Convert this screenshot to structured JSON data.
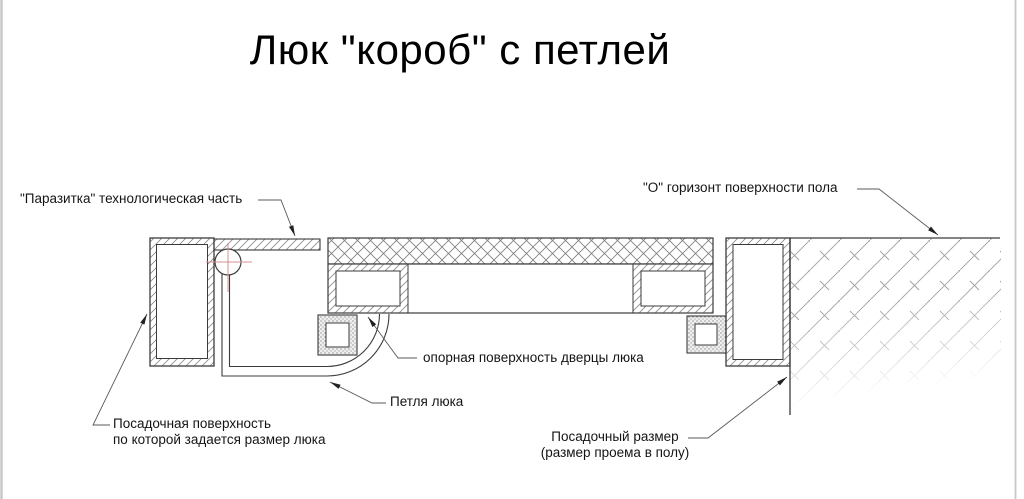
{
  "title": "Люк \"короб\" с петлей",
  "labels": {
    "parasitic_part": "\"Паразитка\" технологическая часть",
    "floor_horizon": "\"О\" горизонт поверхности пола",
    "door_support_surface": "опорная поверхность дверцы люка",
    "hinge": "Петля люка",
    "seating_surface_line1": "Посадочная поверхность",
    "seating_surface_line2": "по которой задается размер люка",
    "seating_size_line1": "Посадочный размер",
    "seating_size_line2": "(размер проема в полу)"
  },
  "colors": {
    "background": "#ffffff",
    "main_line": "#3b3b3b",
    "hatch_line": "#8f8f8f",
    "leader_line": "#5a5a5a",
    "center_mark_red": "#d4908f",
    "screen_edge": "#c8c8c8"
  }
}
